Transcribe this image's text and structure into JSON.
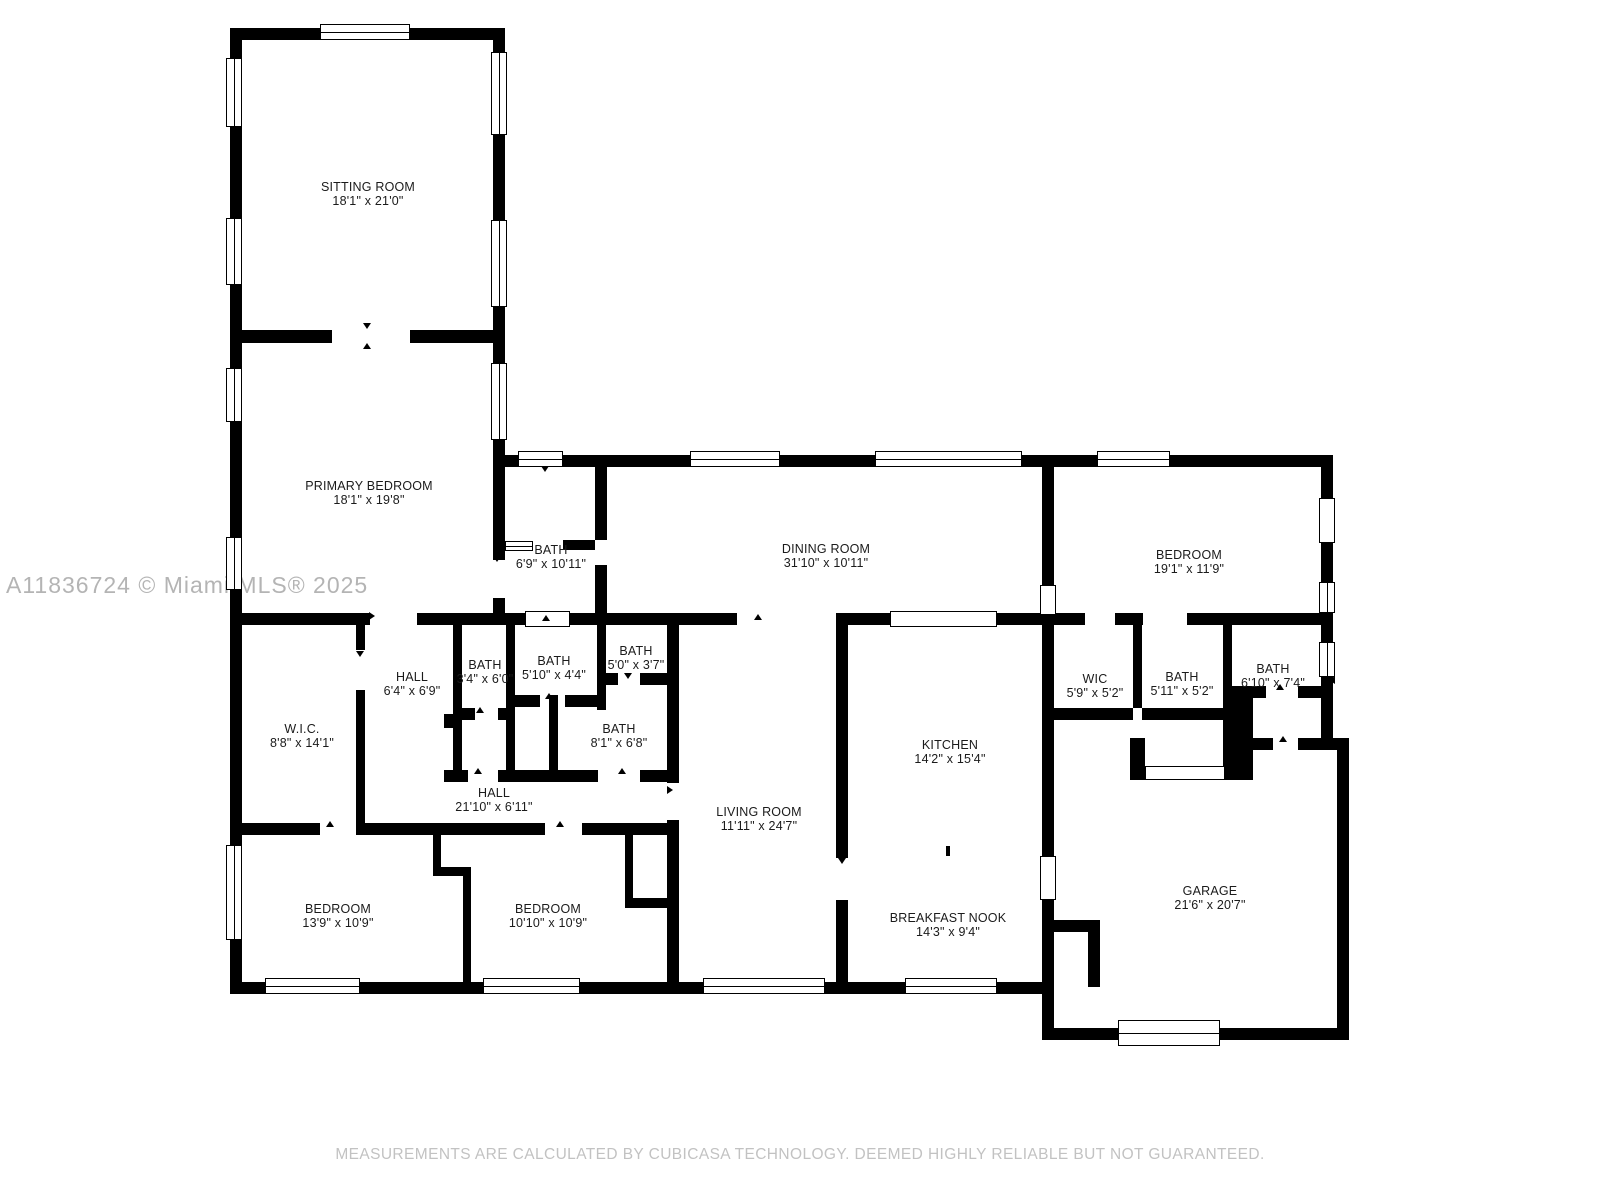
{
  "watermark": "A11836724 © Miami MLS® 2025",
  "disclaimer": "MEASUREMENTS ARE CALCULATED BY CUBICASA TECHNOLOGY. DEEMED HIGHLY RELIABLE BUT NOT GUARANTEED.",
  "colors": {
    "wall": "#000000",
    "label": "#1b1b1b",
    "watermark": "#b4b4b4",
    "disclaimer": "#c2c2c2"
  },
  "rooms": [
    {
      "name": "SITTING ROOM",
      "dims": "18'1\" x 21'0\""
    },
    {
      "name": "PRIMARY BEDROOM",
      "dims": "18'1\" x 19'8\""
    },
    {
      "name": "BATH",
      "dims": "6'9\" x 10'11\""
    },
    {
      "name": "DINING ROOM",
      "dims": "31'10\" x 10'11\""
    },
    {
      "name": "BEDROOM",
      "dims": "19'1\" x 11'9\""
    },
    {
      "name": "HALL",
      "dims": "6'4\" x 6'9\""
    },
    {
      "name": "BATH",
      "dims": "3'4\" x 6'0\""
    },
    {
      "name": "BATH",
      "dims": "5'10\" x 4'4\""
    },
    {
      "name": "BATH",
      "dims": "5'0\" x 3'7\""
    },
    {
      "name": "W.I.C.",
      "dims": "8'8\" x 14'1\""
    },
    {
      "name": "BATH",
      "dims": "8'1\" x 6'8\""
    },
    {
      "name": "WIC",
      "dims": "5'9\" x 5'2\""
    },
    {
      "name": "BATH",
      "dims": "5'11\" x 5'2\""
    },
    {
      "name": "BATH",
      "dims": "6'10\" x 7'4\""
    },
    {
      "name": "HALL",
      "dims": "21'10\" x 6'11\""
    },
    {
      "name": "KITCHEN",
      "dims": "14'2\" x 15'4\""
    },
    {
      "name": "LIVING ROOM",
      "dims": "11'11\" x 24'7\""
    },
    {
      "name": "BEDROOM",
      "dims": "13'9\" x 10'9\""
    },
    {
      "name": "BEDROOM",
      "dims": "10'10\" x 10'9\""
    },
    {
      "name": "BREAKFAST NOOK",
      "dims": "14'3\" x 9'4\""
    },
    {
      "name": "GARAGE",
      "dims": "21'6\" x 20'7\""
    }
  ]
}
